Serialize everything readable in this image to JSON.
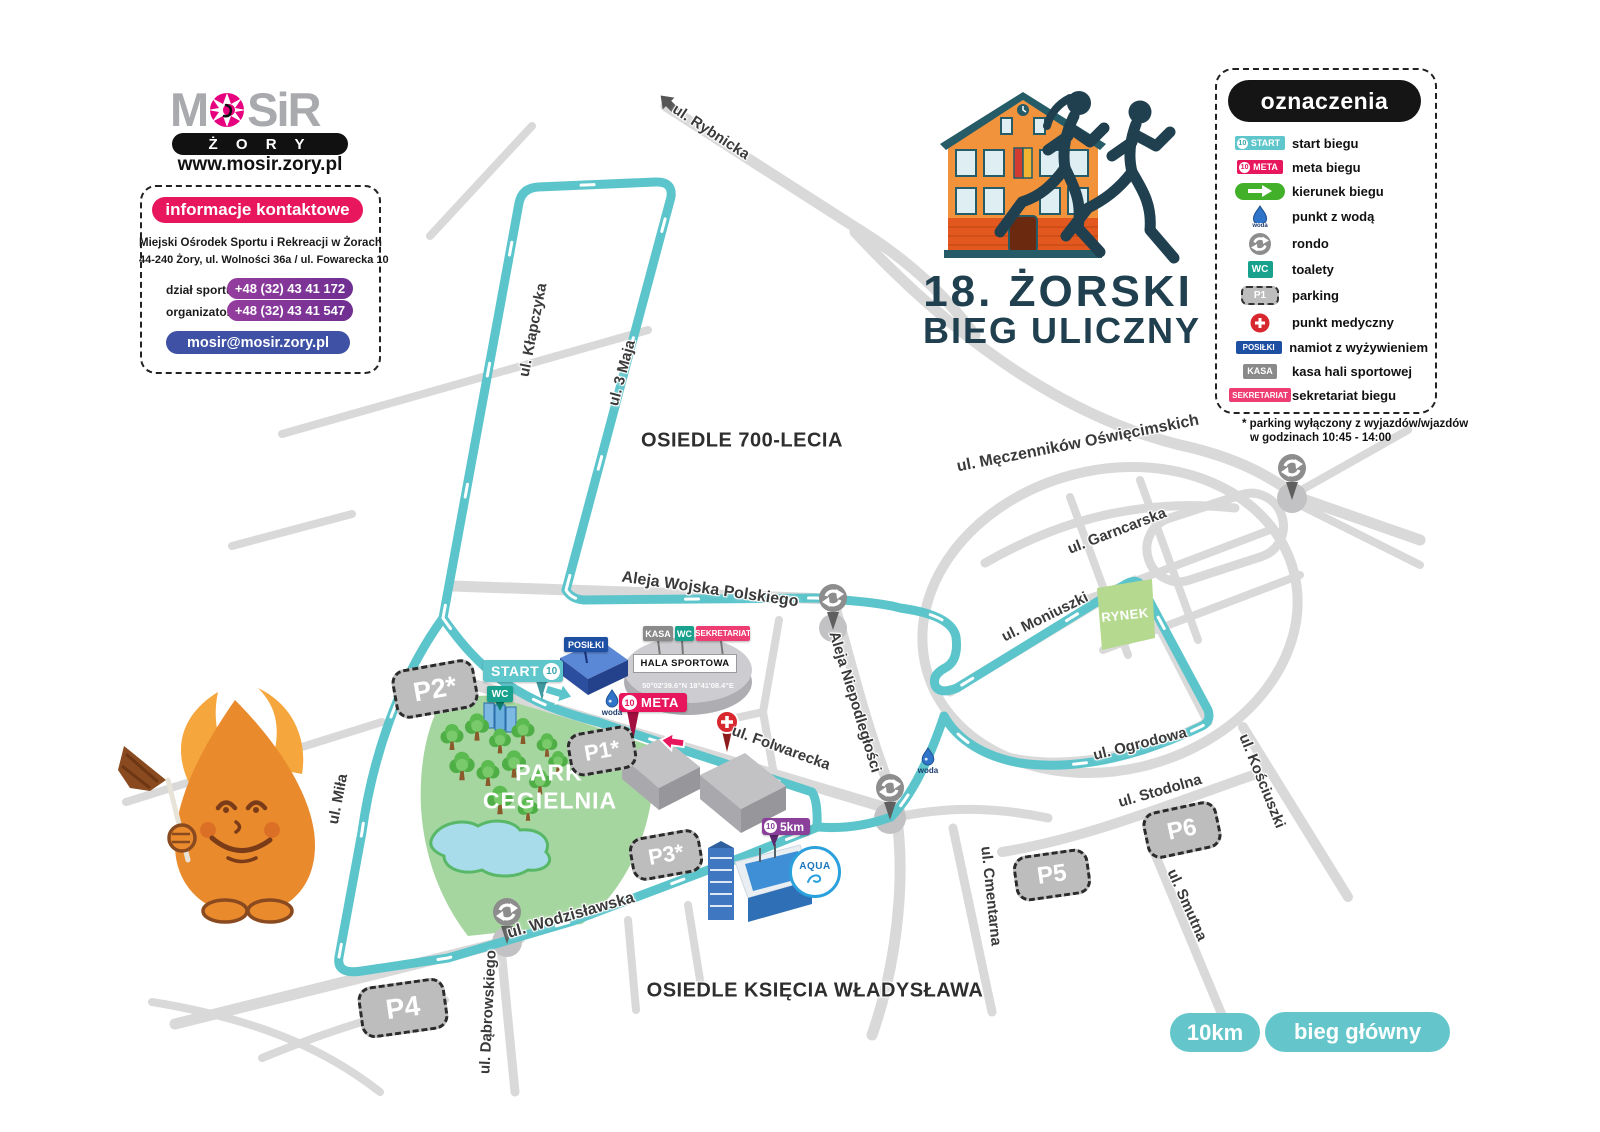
{
  "branding": {
    "logo_m": "M",
    "logo_sir": "SiR",
    "city": "Ż O R Y",
    "url": "www.mosir.zory.pl"
  },
  "contact": {
    "title": "informacje kontaktowe",
    "line1": "Miejski Ośrodek Sportu i Rekreacji w Żorach",
    "line2": "44-240 Żory, ul. Wolności 36a / ul. Fowarecka 10",
    "rows": [
      {
        "label": "dział sportu",
        "value": "+48 (32) 43 41 172"
      },
      {
        "label": "organizator",
        "value": "+48 (32) 43 41 547"
      }
    ],
    "email": "mosir@mosir.zory.pl"
  },
  "event": {
    "line1": "18. ŻORSKI",
    "line2": "BIEG ULICZNY"
  },
  "legend": {
    "title": "oznaczenia",
    "p1": "P1",
    "items": [
      {
        "label": "start biegu"
      },
      {
        "label": "meta biegu"
      },
      {
        "label": "kierunek biegu"
      },
      {
        "label": "punkt z wodą"
      },
      {
        "label": "rondo"
      },
      {
        "label": "toalety"
      },
      {
        "label": "parking"
      },
      {
        "label": "punkt medyczny"
      },
      {
        "label": "namiot z wyżywieniem"
      },
      {
        "label": "kasa hali sportowej"
      },
      {
        "label": "sekretariat biegu"
      }
    ],
    "footnote1": "* parking wyłączony z wyjazdów/wjazdów",
    "footnote2": "w godzinach 10:45 - 14:00"
  },
  "map": {
    "streets": [
      "ul. Rybnicka",
      "ul. Kłapczyka",
      "ul. 3 Maja",
      "Aleja Wojska Polskiego",
      "ul. Męczenników Oświęcimskich",
      "ul. Garncarska",
      "ul. Moniuszki",
      "ul. Ogrodowa",
      "ul. Kościuszki",
      "ul. Stodolna",
      "ul. Smutna",
      "ul. Cmentarna",
      "Aleja Niepodległości",
      "ul. Folwarecka",
      "ul. Miła",
      "ul. Wodzisławska",
      "ul. Dąbrowskiego"
    ],
    "areas": {
      "osiedle700": "OSIEDLE 700-LECIA",
      "park1": "PARK",
      "park2": "CEGIELNIA",
      "rynek": "RYNEK",
      "wladyslawa": "OSIEDLE KSIĘCIA WŁADYSŁAWA"
    },
    "parkings": [
      "P2*",
      "P1*",
      "P3*",
      "P4",
      "P5",
      "P6"
    ],
    "badges": {
      "start": "START",
      "meta": "META",
      "num10": "10",
      "km5": "5km",
      "wc": "WC",
      "kasa": "KASA",
      "sekretariat": "SEKRETARIAT",
      "posilki": "POSIŁKI",
      "woda": "woda",
      "hala": "HALA SPORTOWA",
      "coords": "50°02'39.6\"N 18°41'08.4\"E",
      "aqua": "AQUA"
    },
    "footer": {
      "km": "10km",
      "main": "bieg główny"
    }
  }
}
